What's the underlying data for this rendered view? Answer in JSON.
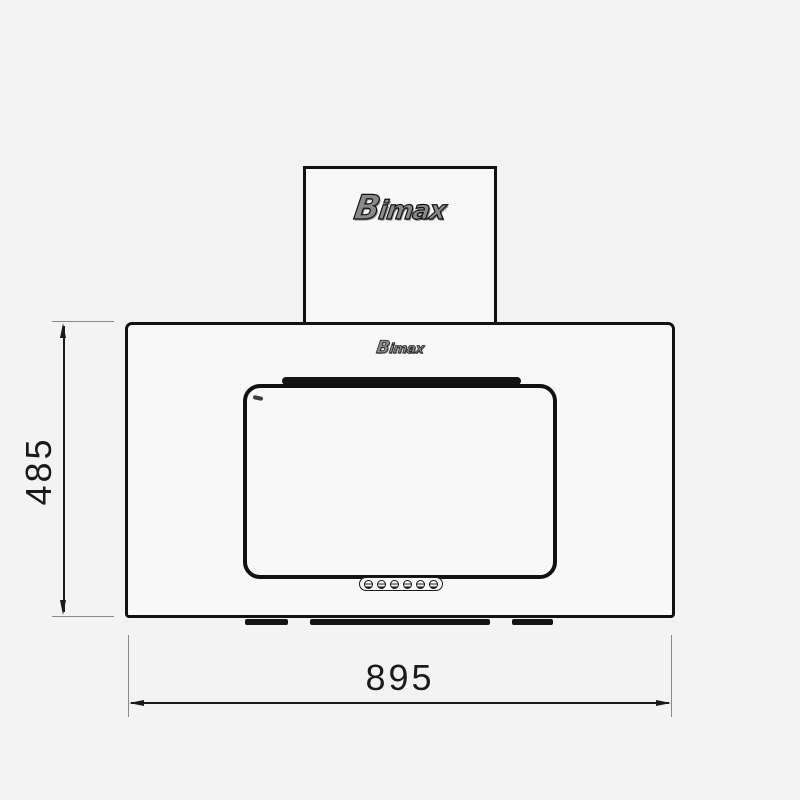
{
  "diagram": {
    "kind": "product dimension drawing — kitchen range hood, front view",
    "brand": "Bimax",
    "chimney_logo": "Bimax",
    "body_logo": "Bimax",
    "height_dim": "485",
    "width_dim": "895",
    "control_button_count": 6,
    "vent_segments": [
      {
        "left": 245,
        "width": 43
      },
      {
        "left": 310,
        "width": 180
      },
      {
        "left": 512,
        "width": 41
      }
    ],
    "colors": {
      "background": "#f3f3f3",
      "surface": "#f8f8f8",
      "line": "#111111",
      "dim_line": "#1a1a1a",
      "ext_line": "#888888"
    }
  }
}
